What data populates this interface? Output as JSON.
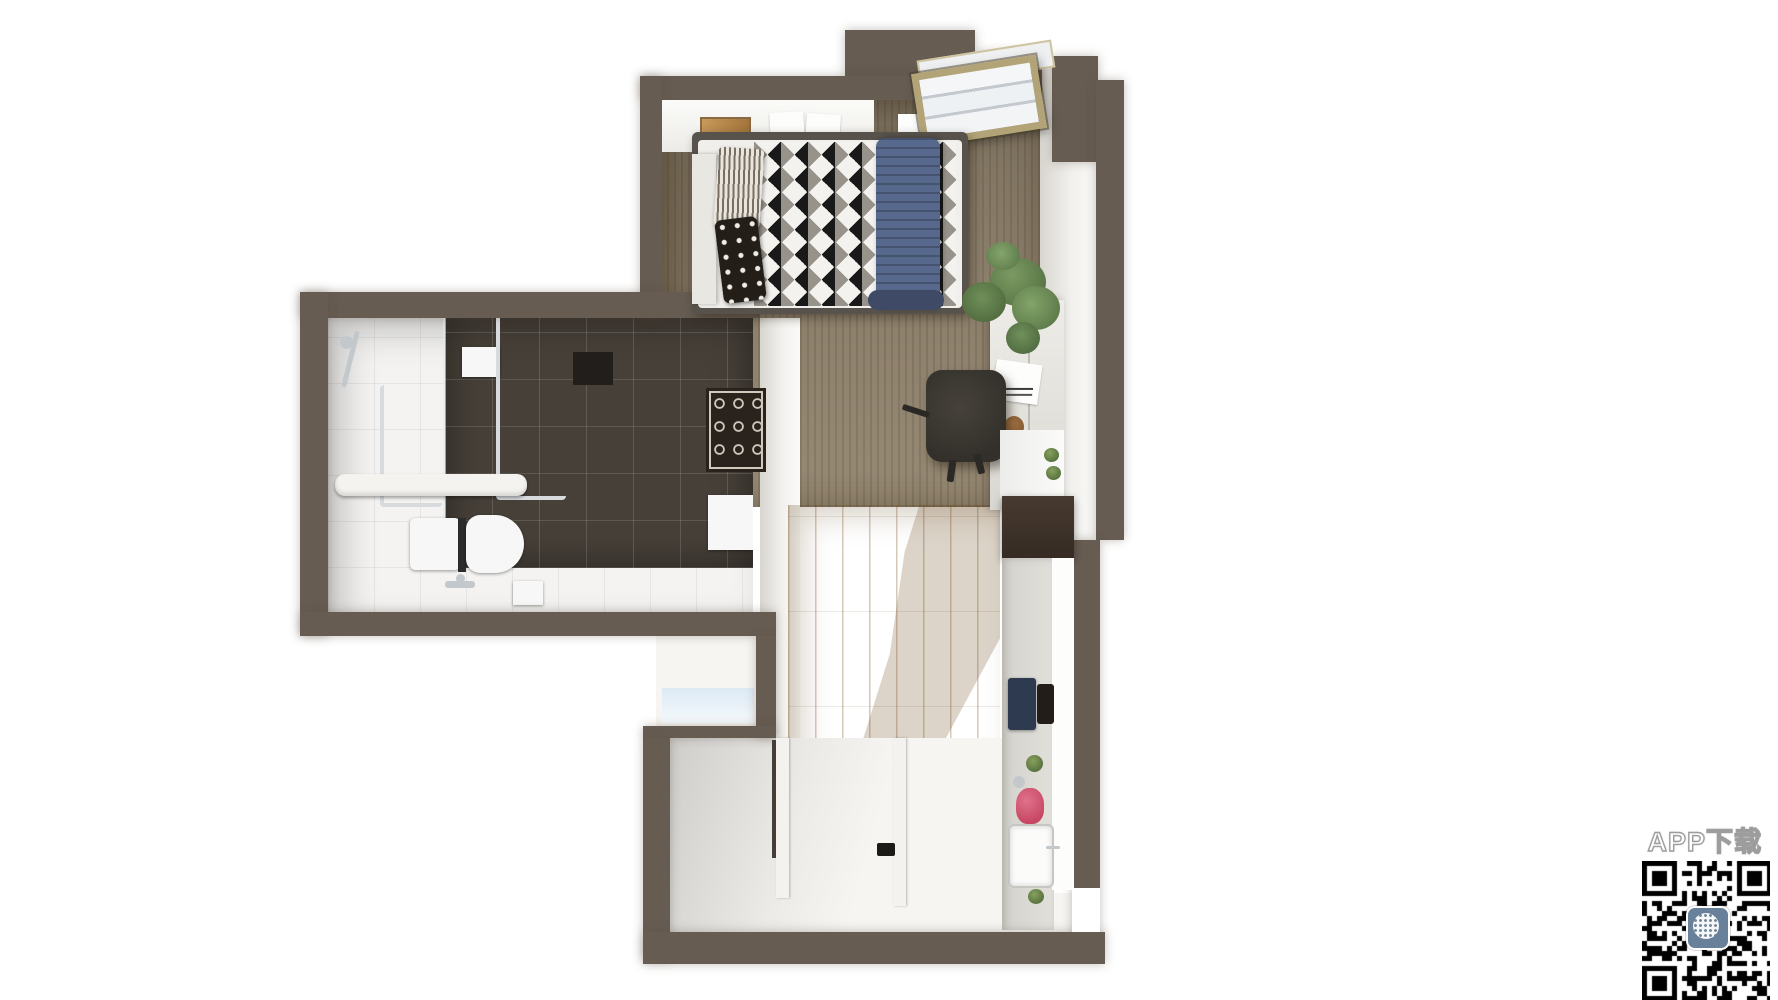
{
  "watermark": {
    "app_download_label": "APP下载",
    "qr": {
      "modules": 26,
      "icon": "app-logo-globe"
    }
  },
  "colors": {
    "wall": "#665c52",
    "carpet": "#8b7e6a",
    "wood": "#d8b172",
    "tile-dark": "#474039",
    "tile-light": "#f4f3f1",
    "blanket-blue": "#56688b",
    "kettle-pink": "#d2526e",
    "plant-green": "#6a8a52",
    "qr-icon": "#68809a",
    "floor-white": "#f6f5f2"
  },
  "scene": {
    "type": "3d-floorplan-top-down-render",
    "rooms": [
      {
        "name": "bedroom",
        "items": [
          "double-bed",
          "striped-pillow",
          "polka-dot-pillow",
          "blue-blanket",
          "skylight-window",
          "wall-shelf",
          "papers",
          "wooden-tray",
          "carpet-floor"
        ]
      },
      {
        "name": "bathroom",
        "items": [
          "toilet",
          "shower-set",
          "towel-rail",
          "chrome-pipes",
          "bath-mat-rug",
          "dark-wall-tiles",
          "white-floor-tiles"
        ]
      },
      {
        "name": "workspace",
        "items": [
          "desk",
          "office-chair",
          "potted-plant",
          "notebook",
          "cup",
          "small-plant"
        ]
      },
      {
        "name": "kitchen",
        "items": [
          "upper-cabinet",
          "counter",
          "cooktop",
          "pot",
          "kettle",
          "sink",
          "herb-pots"
        ]
      },
      {
        "name": "entry",
        "items": [
          "wood-floor",
          "closet",
          "sliding-door-tracks",
          "doorstop"
        ]
      }
    ]
  }
}
